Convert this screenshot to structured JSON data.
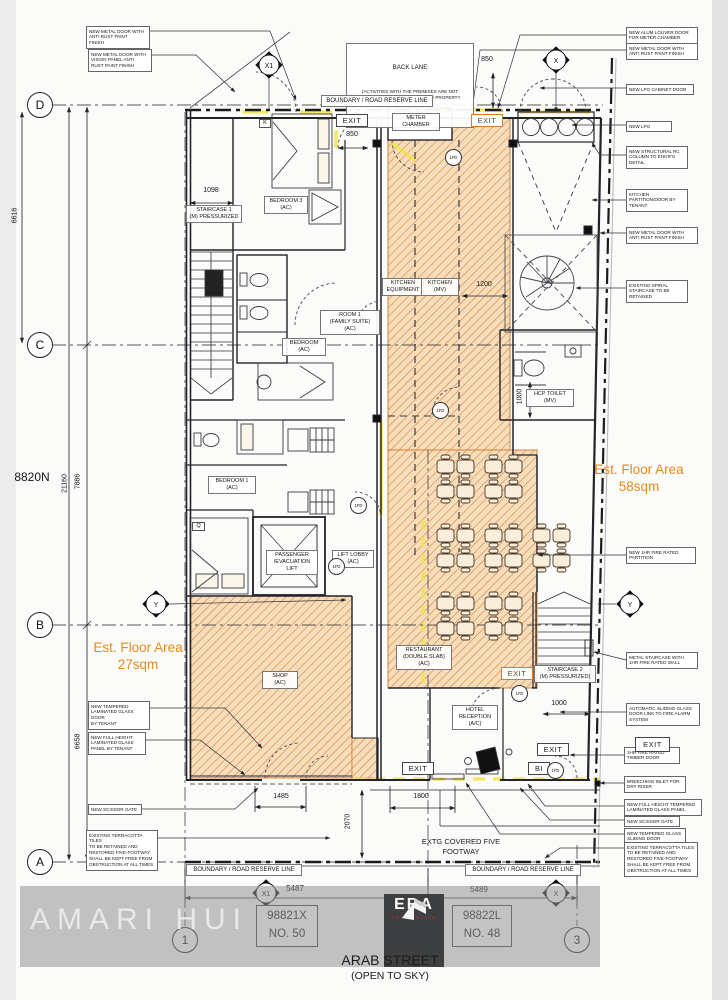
{
  "labels": {
    "exit": "EXIT",
    "bi": "BI",
    "fd": "1FD",
    "boundary": "BOUNDARY / ROAD RESERVE LINE",
    "back_lane_title": "BACK LANE",
    "back_lane_body": "(ACTIVITIES WITH THE PREMISES ARE NOT\nALLOWED TO SPILL BEYOND THE PROPERTY\nBOUNDARY)",
    "footway": "EXTG COVERED FIVE\nFOOTWAY",
    "north_ref": "8820N"
  },
  "street": {
    "name": "ARAB STREET",
    "note": "(OPEN TO SKY)"
  },
  "grid": {
    "rows": [
      "D",
      "C",
      "B",
      "A"
    ],
    "cols": [
      "1",
      "2",
      "3"
    ]
  },
  "markers": {
    "x1": "X1",
    "x": "X",
    "y": "Y",
    "k": "K",
    "q": "Q"
  },
  "dims": {
    "v_left_upper": "6616",
    "v_total": "21160",
    "v_mid": "7886",
    "v_left_lower": "6658",
    "stair1_width": "1098",
    "exit_door_top": "850",
    "meter_side": "850",
    "kitchen_opening": "1200",
    "hcp_depth": "1000",
    "stair2_width": "1000",
    "shop_door": "1485",
    "hotel_front": "1800",
    "footway_depth": "2070",
    "bay_1": "5487",
    "bay_2": "5489"
  },
  "rooms": {
    "staircase1": "STAIRCASE 1\n(M) PRESSURIZED",
    "bedroom3": "BEDROOM 3\n(AC)",
    "room1": "ROOM 1\n(FAMILY SUITE)\n(AC)",
    "bedroom": "BEDROOM\n(AC)",
    "bedroom1": "BEDROOM 1\n(AC)",
    "lift": "PASSENGER\n/EVACUATION\nLIFT",
    "lift_lobby": "LIFT LOBBY\n(AC)",
    "kitchen_equipment": "KITCHEN\nEQUIPMENT",
    "kitchen": "KITCHEN\n(MV)",
    "meter_chamber": "METER\nCHAMBER",
    "hcp_toilet": "HCP TOILET\n(MV)",
    "restaurant": "RESTAURANT\n(DOUBLE SLAB)\n(AC)",
    "hotel_reception": "HOTEL\nRECEPTION\n(A/C)",
    "shop": "SHOP\n(AC)",
    "staircase2": "STAIRCASE 2\n(M) PRESSURIZED)"
  },
  "areas": {
    "restaurant": "Est. Floor Area\n58sqm",
    "shop": "Est. Floor Area\n27sqm"
  },
  "annotations": {
    "tl1": "NEW METAL DOOR WITH\nANTI RUST PAINT\nFINISH",
    "tl2": "NEW METAL DOOR WITH\nVISION PANEL ANTI\nRUST PAINT FINISH",
    "r1": "NEW ALUM LOUVER DOOR\nFOR METER CHAMBER",
    "r2": "NEW METAL DOOR WITH\nANTI RUST PAINT FINISH",
    "r3": "NEW LPG CABINET DOOR",
    "r4": "NEW LPG",
    "r5": "NEW STRUCTURAL RC\nCOLUMN TO ENGR'S\nDETAIL",
    "r6": "KITCHEN\nPARTITION/DOOR BY\nTENANT",
    "r7": "NEW METAL DOOR WITH\nANTI RUST PAINT FINISH",
    "r8": "EXISTING SPIRAL\nSTAIRCASE TO BE\nRETAINED",
    "r9": "NEW 1HR FIRE RATED\nPARTITION",
    "r10": "METAL STAIRCASE WITH\n1HR FIRE RATED WALL",
    "r11": "AUTOMATIC SLIDING GLASS\nDOOR LINK TO FIRE ALARM\nSYSTEM",
    "r12": "1HR FIRE RATED\nTIMBER DOOR",
    "r13": "BREECHING INLET FOR\nDRY RISER",
    "r14": "NEW FULL HEIGHT TEMPERED\nLAMINATED GLASS PANEL",
    "r15": "NEW SCISSOR GATE",
    "r16": "NEW TEMPERED GLASS\nSLIDING DOOR",
    "r17": "EXISTING TERRACOTTA TILES\nTO BE RETAINED AND\nRESTORED FIVE-FOOTWAY\nSHALL BE KEPT FREE FROM\nOBSTRUCTION AT ALL TIMES",
    "l1": "NEW TEMPERED\nLAMINATED GLASS DOOR\nBY TENANT",
    "l2": "NEW FULL HEIGHT\nLAMINATED GLASS\nPANEL BY TENANT",
    "l3": "NEW SCISSOR GATE",
    "l4": "EXISTING TERRACOTTA TILES\nTO BE RETAINED AND\nRESTORED FIVE-FOOTWAY\nSHALL BE KEPT FREE FROM\nOBSTRUCTION AT ALL TIMES"
  },
  "plots": {
    "p1": "98821X\nNO. 50",
    "p2": "98822L\nNO. 48"
  },
  "watermark": {
    "name": "AMARI HUI",
    "logo_title": "ERA",
    "logo_sub": "REAL ESTATE"
  },
  "colors": {
    "hatch": "#cf8345",
    "hatch_bg": "#f8ddbb",
    "accent_orange": "#e8891c",
    "highlight": "#f2e542"
  }
}
